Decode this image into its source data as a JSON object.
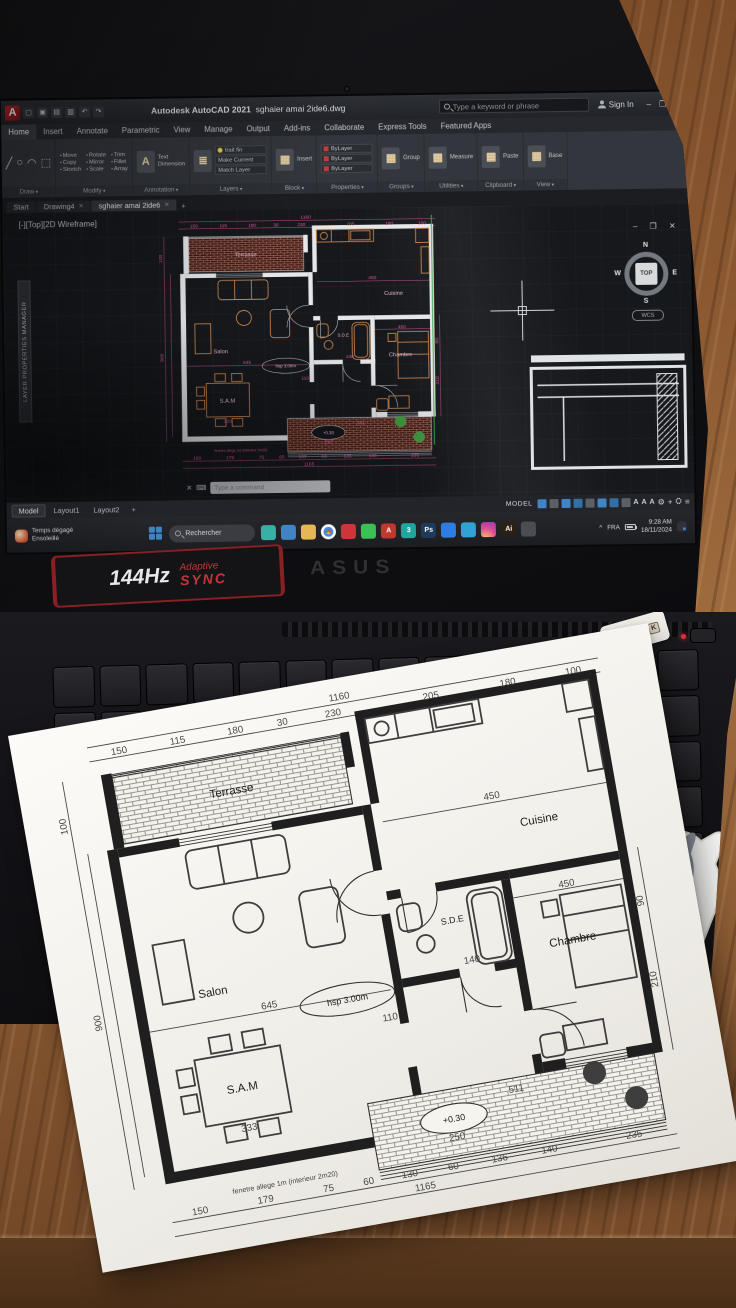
{
  "colors": {
    "accent_magenta": "#e056a4",
    "cad_wall": "#e6e7e9",
    "cad_furniture": "#c8834b",
    "green_guide": "#37a837",
    "taskbar_blue": "#3d85c8",
    "autocad_red": "#b5272d",
    "sticker_red": "#c6343b",
    "dts_orange": "#e87f28",
    "geforce_green": "#76b900",
    "paper": "#f5f3ee",
    "wood": "#8a5a33"
  },
  "autocad": {
    "app_title": "Autodesk AutoCAD 2021",
    "doc_name": "sghaier amai 2ide6.dwg",
    "search_placeholder": "Type a keyword or phrase",
    "sign_in": "Sign In",
    "window_controls": {
      "min": "–",
      "restore": "❐",
      "close": "✕"
    },
    "undo_glyph": "↶",
    "redo_glyph": "↷",
    "ribbon_tabs": [
      "Home",
      "Insert",
      "Annotate",
      "Parametric",
      "View",
      "Manage",
      "Output",
      "Add-ins",
      "Collaborate",
      "Express Tools",
      "Featured Apps"
    ],
    "panels": [
      {
        "title": "Draw",
        "type": "glyphs",
        "items": [
          "Line",
          "Polyline",
          "Circle",
          "Arc"
        ],
        "glyphs": [
          "╱",
          "○",
          "◠",
          "⬚"
        ]
      },
      {
        "title": "Modify",
        "type": "grid",
        "items": [
          "Move",
          "Rotate",
          "Trim",
          "Copy",
          "Mirror",
          "Fillet",
          "Stretch",
          "Scale",
          "Array"
        ]
      },
      {
        "title": "Annotation",
        "type": "big",
        "big": "A",
        "items": [
          "Text",
          "Dimension",
          "Table"
        ]
      },
      {
        "title": "Layers",
        "type": "layers",
        "items": [
          "trait fin",
          "Make Current",
          "Match Layer"
        ]
      },
      {
        "title": "Block",
        "type": "simple",
        "items": [
          "Insert"
        ]
      },
      {
        "title": "Properties",
        "type": "props",
        "items": [
          "Match",
          "ByLayer",
          "ByLayer",
          "ByLayer"
        ]
      },
      {
        "title": "Groups",
        "type": "simple",
        "items": [
          "Group"
        ]
      },
      {
        "title": "Utilities",
        "type": "simple",
        "items": [
          "Measure"
        ]
      },
      {
        "title": "Clipboard",
        "type": "simple",
        "items": [
          "Paste"
        ]
      },
      {
        "title": "View",
        "type": "simple",
        "items": [
          "Base"
        ]
      }
    ],
    "file_tabs": [
      "Start",
      "Drawing4",
      "sghaier amai 2ide6"
    ],
    "new_tab_button": "+",
    "viewport_label": "[-][Top][2D Wireframe]",
    "palette_tab": "LAYER PROPERTIES MANAGER",
    "command_hint": "Type a command",
    "viewcube": {
      "n": "N",
      "e": "E",
      "s": "S",
      "w": "W",
      "top": "TOP",
      "wcs": "WCS"
    },
    "layout_tabs": [
      "Model",
      "Layout1",
      "Layout2"
    ],
    "status_model_label": "MODEL"
  },
  "plan": {
    "labels": {
      "terrasse": "Terrasse",
      "salon": "Salon",
      "cuisine": "Cuisine",
      "sde": "S.D.E",
      "chambre": "Chambre",
      "sam": "S.A.M",
      "height_note": "hsp 3.00m",
      "level": "+0.30",
      "level_dim": "250"
    },
    "dims": {
      "top_total": "1160",
      "top": [
        "150",
        "115",
        "180",
        "30",
        "230",
        "205",
        "180",
        "100"
      ],
      "left": [
        "100",
        "900"
      ],
      "right": [
        "90",
        "210"
      ],
      "right_bottom": "235",
      "bottom": [
        "150",
        "179",
        "75",
        "60",
        "130",
        "60",
        "136",
        "140"
      ],
      "bottom_total": "1165",
      "cuisine_w": "450",
      "hall": "110",
      "salon_w": "645",
      "chambre_w": "450",
      "sde": "140",
      "sam": "333",
      "terrace": "511"
    },
    "note": "fenetre allege 1m (interieur 2m20)"
  },
  "taskbar": {
    "weather_line1": "Temps dégagé",
    "weather_line2": "Ensoleillé",
    "search_placeholder": "Rechercher",
    "tray": {
      "lang": "FRA",
      "time": "9:28 AM",
      "date": "18/11/2024",
      "caret": "^"
    },
    "apps": [
      {
        "name": "edge",
        "color": "#2fb3a7"
      },
      {
        "name": "file-explorer",
        "color": "#3d85c8"
      },
      {
        "name": "folder",
        "color": "#e8b84b"
      },
      {
        "name": "chrome",
        "color": "chrome"
      },
      {
        "name": "acrobat",
        "color": "#d6323a"
      },
      {
        "name": "whatsapp",
        "color": "#37c24f"
      },
      {
        "name": "adobe",
        "color": "#c7342c",
        "glyph": "A"
      },
      {
        "name": "3ds-max",
        "color": "#1ba8a0",
        "glyph": "3"
      },
      {
        "name": "photoshop",
        "color": "#1d3a5f",
        "glyph": "Ps"
      },
      {
        "name": "messenger",
        "color": "#2a7de8"
      },
      {
        "name": "telegram",
        "color": "#2ca3d8"
      },
      {
        "name": "instagram",
        "color": "insta"
      },
      {
        "name": "illustrator",
        "color": "#2b2012",
        "glyph": "Ai"
      },
      {
        "name": "settings",
        "color": "#4a4d52"
      }
    ]
  },
  "laptop": {
    "brand": "ASUS",
    "refresh_rate": "144Hz",
    "adaptive_line1": "Adaptive",
    "adaptive_line2": "SYNC",
    "risk": [
      "R",
      "I",
      "S",
      "K"
    ],
    "keyboard_rows": [
      14,
      14,
      14,
      14,
      13,
      9
    ],
    "stickers": {
      "she_line1": "SHE'S IS LUCKY",
      "she_line2": "SHE WORKS HARD",
      "dts": "dts",
      "nvidia": "NVIDIA",
      "geforce": "GEFORCE GTX",
      "hdmi": "HDMI",
      "ddr": "DDR5",
      "ddr_speed": "4800MHz",
      "ddr_sub": "High Performance DDR5 RAM",
      "military_1": "Military Standard",
      "military_2": "Durability",
      "amd": "AMD",
      "ryzen": "RYZEN",
      "ryzen_series": "7000 SERIES",
      "serial": "15100-2071E100"
    }
  }
}
